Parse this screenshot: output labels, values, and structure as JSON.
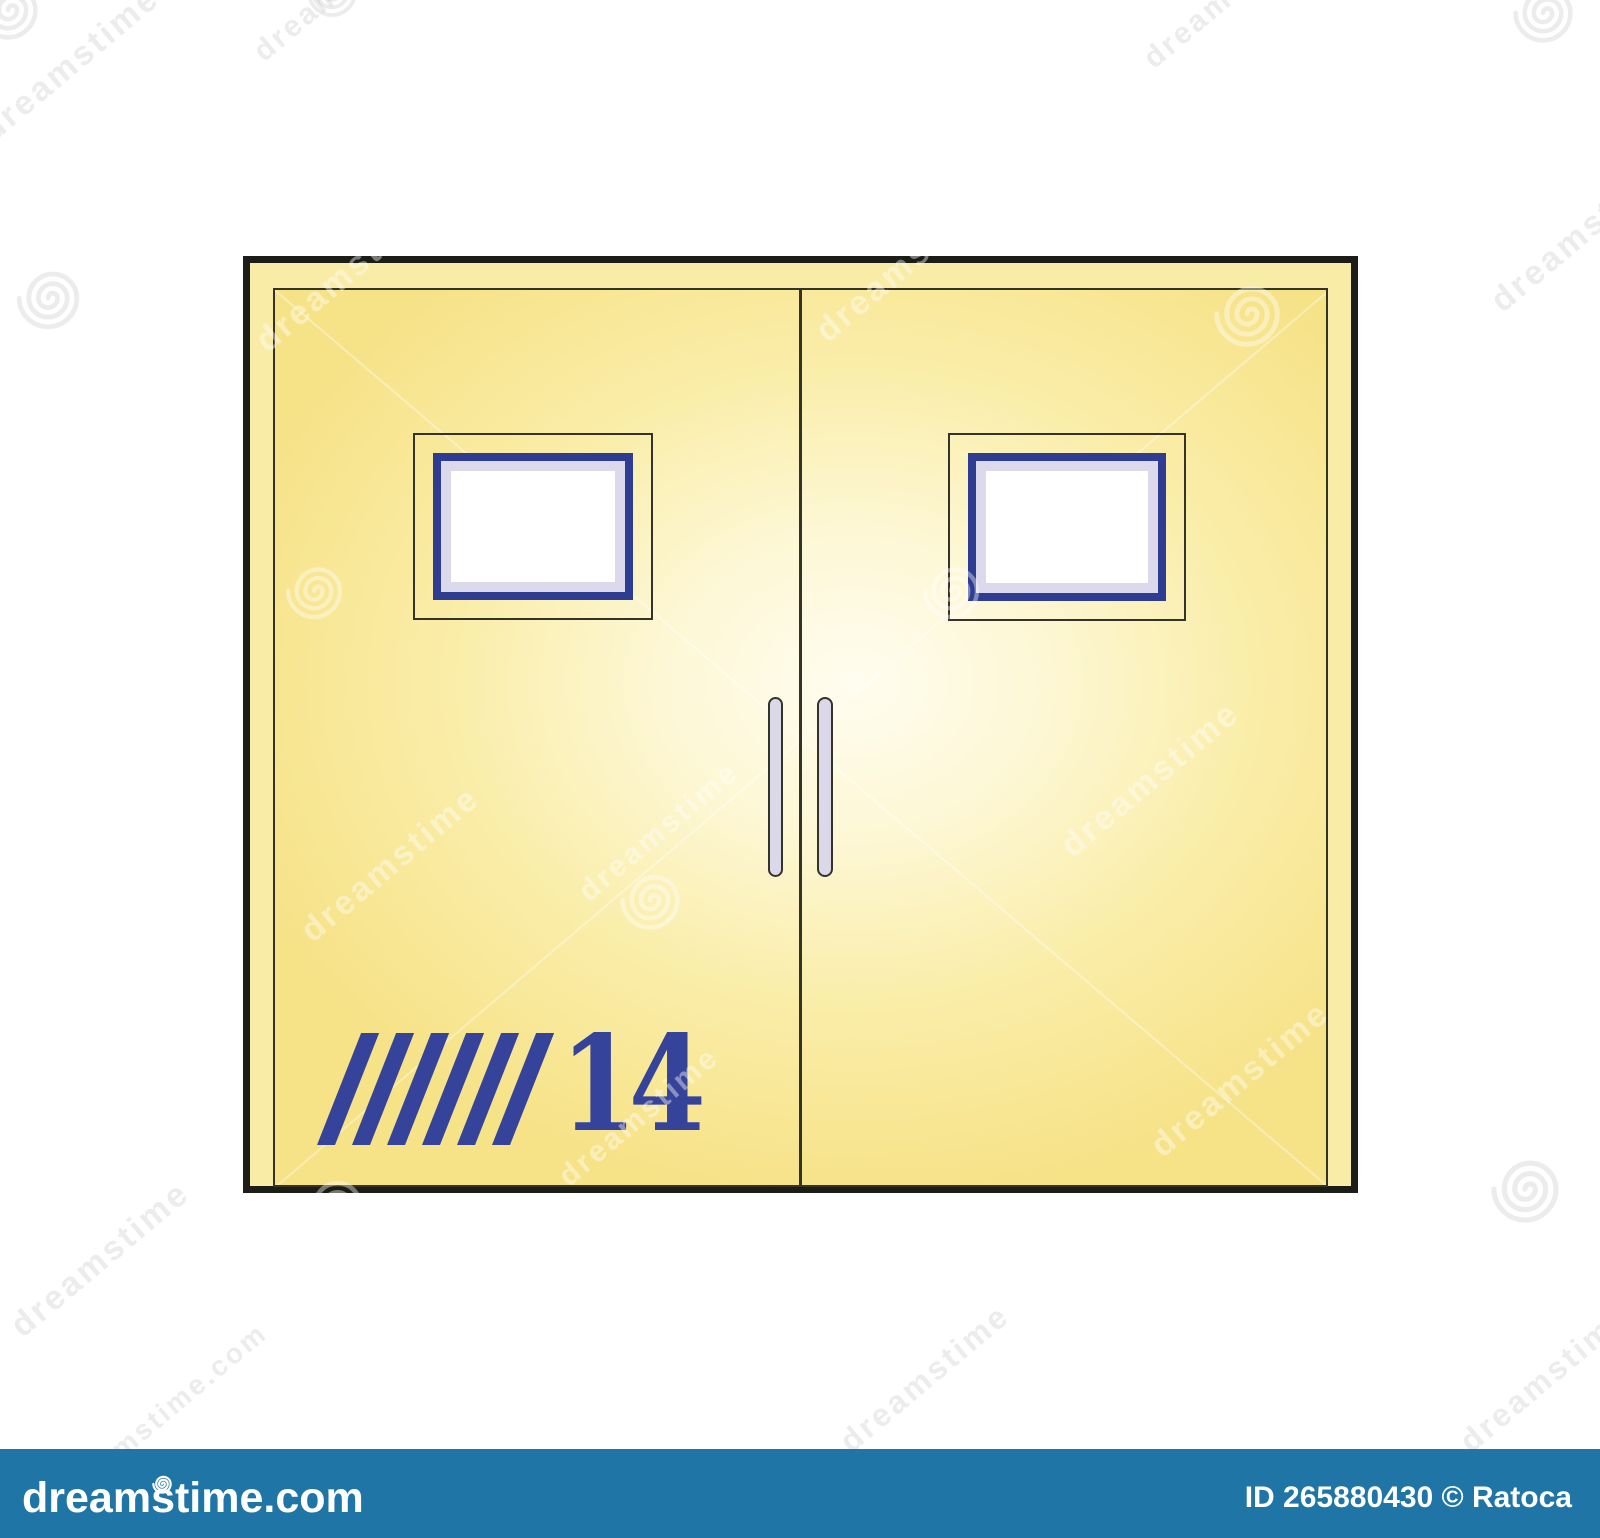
{
  "canvas": {
    "width": 1600,
    "height": 1538,
    "background": "#ffffff"
  },
  "door": {
    "number": "14",
    "stripes": {
      "count": 6
    },
    "colors": {
      "frame_border": "#1d1d17",
      "frame_fill": "#f9eca6",
      "panel_light": "#fffdf0",
      "panel_mid": "#faeda8",
      "panel_deep": "#f6e287",
      "outline": "#33332a",
      "window_blue": "#2e3d92",
      "window_lavender": "#dcd9ec",
      "window_pane": "#ffffff",
      "handle_fill": "#dbd8ea",
      "accent_blue": "#35439a"
    }
  },
  "watermark": {
    "brand": "dreamstime",
    "domain": "dreamstime.com",
    "credit": "ID 265880430 © Ratoca",
    "bar_color": "#1f76a6",
    "text_color": "#ffffff"
  }
}
